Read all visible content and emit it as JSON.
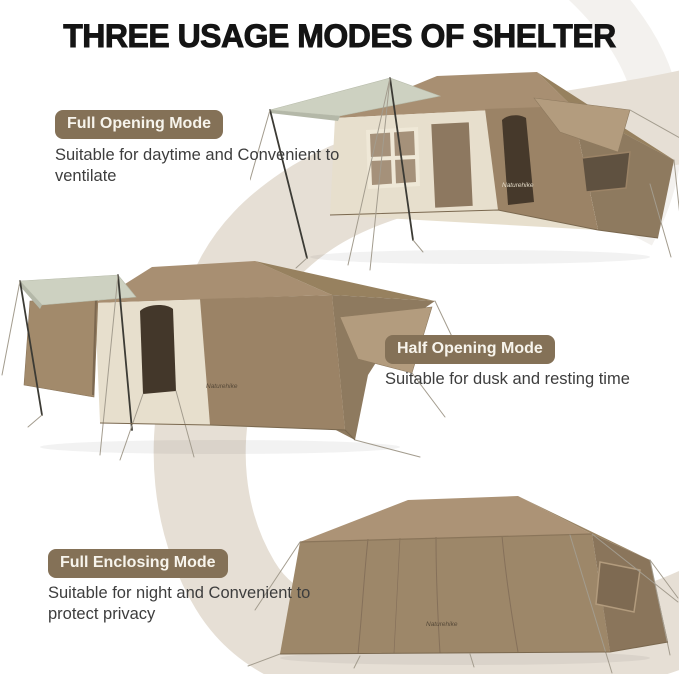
{
  "title": "THREE USAGE MODES OF SHELTER",
  "brand_logo": "Naturehike",
  "modes": [
    {
      "label": "Full Opening Mode",
      "description": "Suitable for daytime and Convenient to ventilate"
    },
    {
      "label": "Half Opening Mode",
      "description": "Suitable for dusk and resting time"
    },
    {
      "label": "Full Enclosing Mode",
      "description": "Suitable for night and Convenient to protect privacy"
    }
  ],
  "colors": {
    "badge_background": "#847157",
    "badge_text": "#f7f4ec",
    "title_text": "#141414",
    "body_text": "#3d3d3d",
    "swoosh_band": "#e6dfd5",
    "swoosh_band_light": "#f3f1ee",
    "tent_fabric": "#a88f72",
    "tent_fabric_dark": "#8e7a5f",
    "tent_inner_wall": "#e7dfcd",
    "tent_opening_dark": "#46392b",
    "awning_tarp": "#cdd1c1"
  }
}
